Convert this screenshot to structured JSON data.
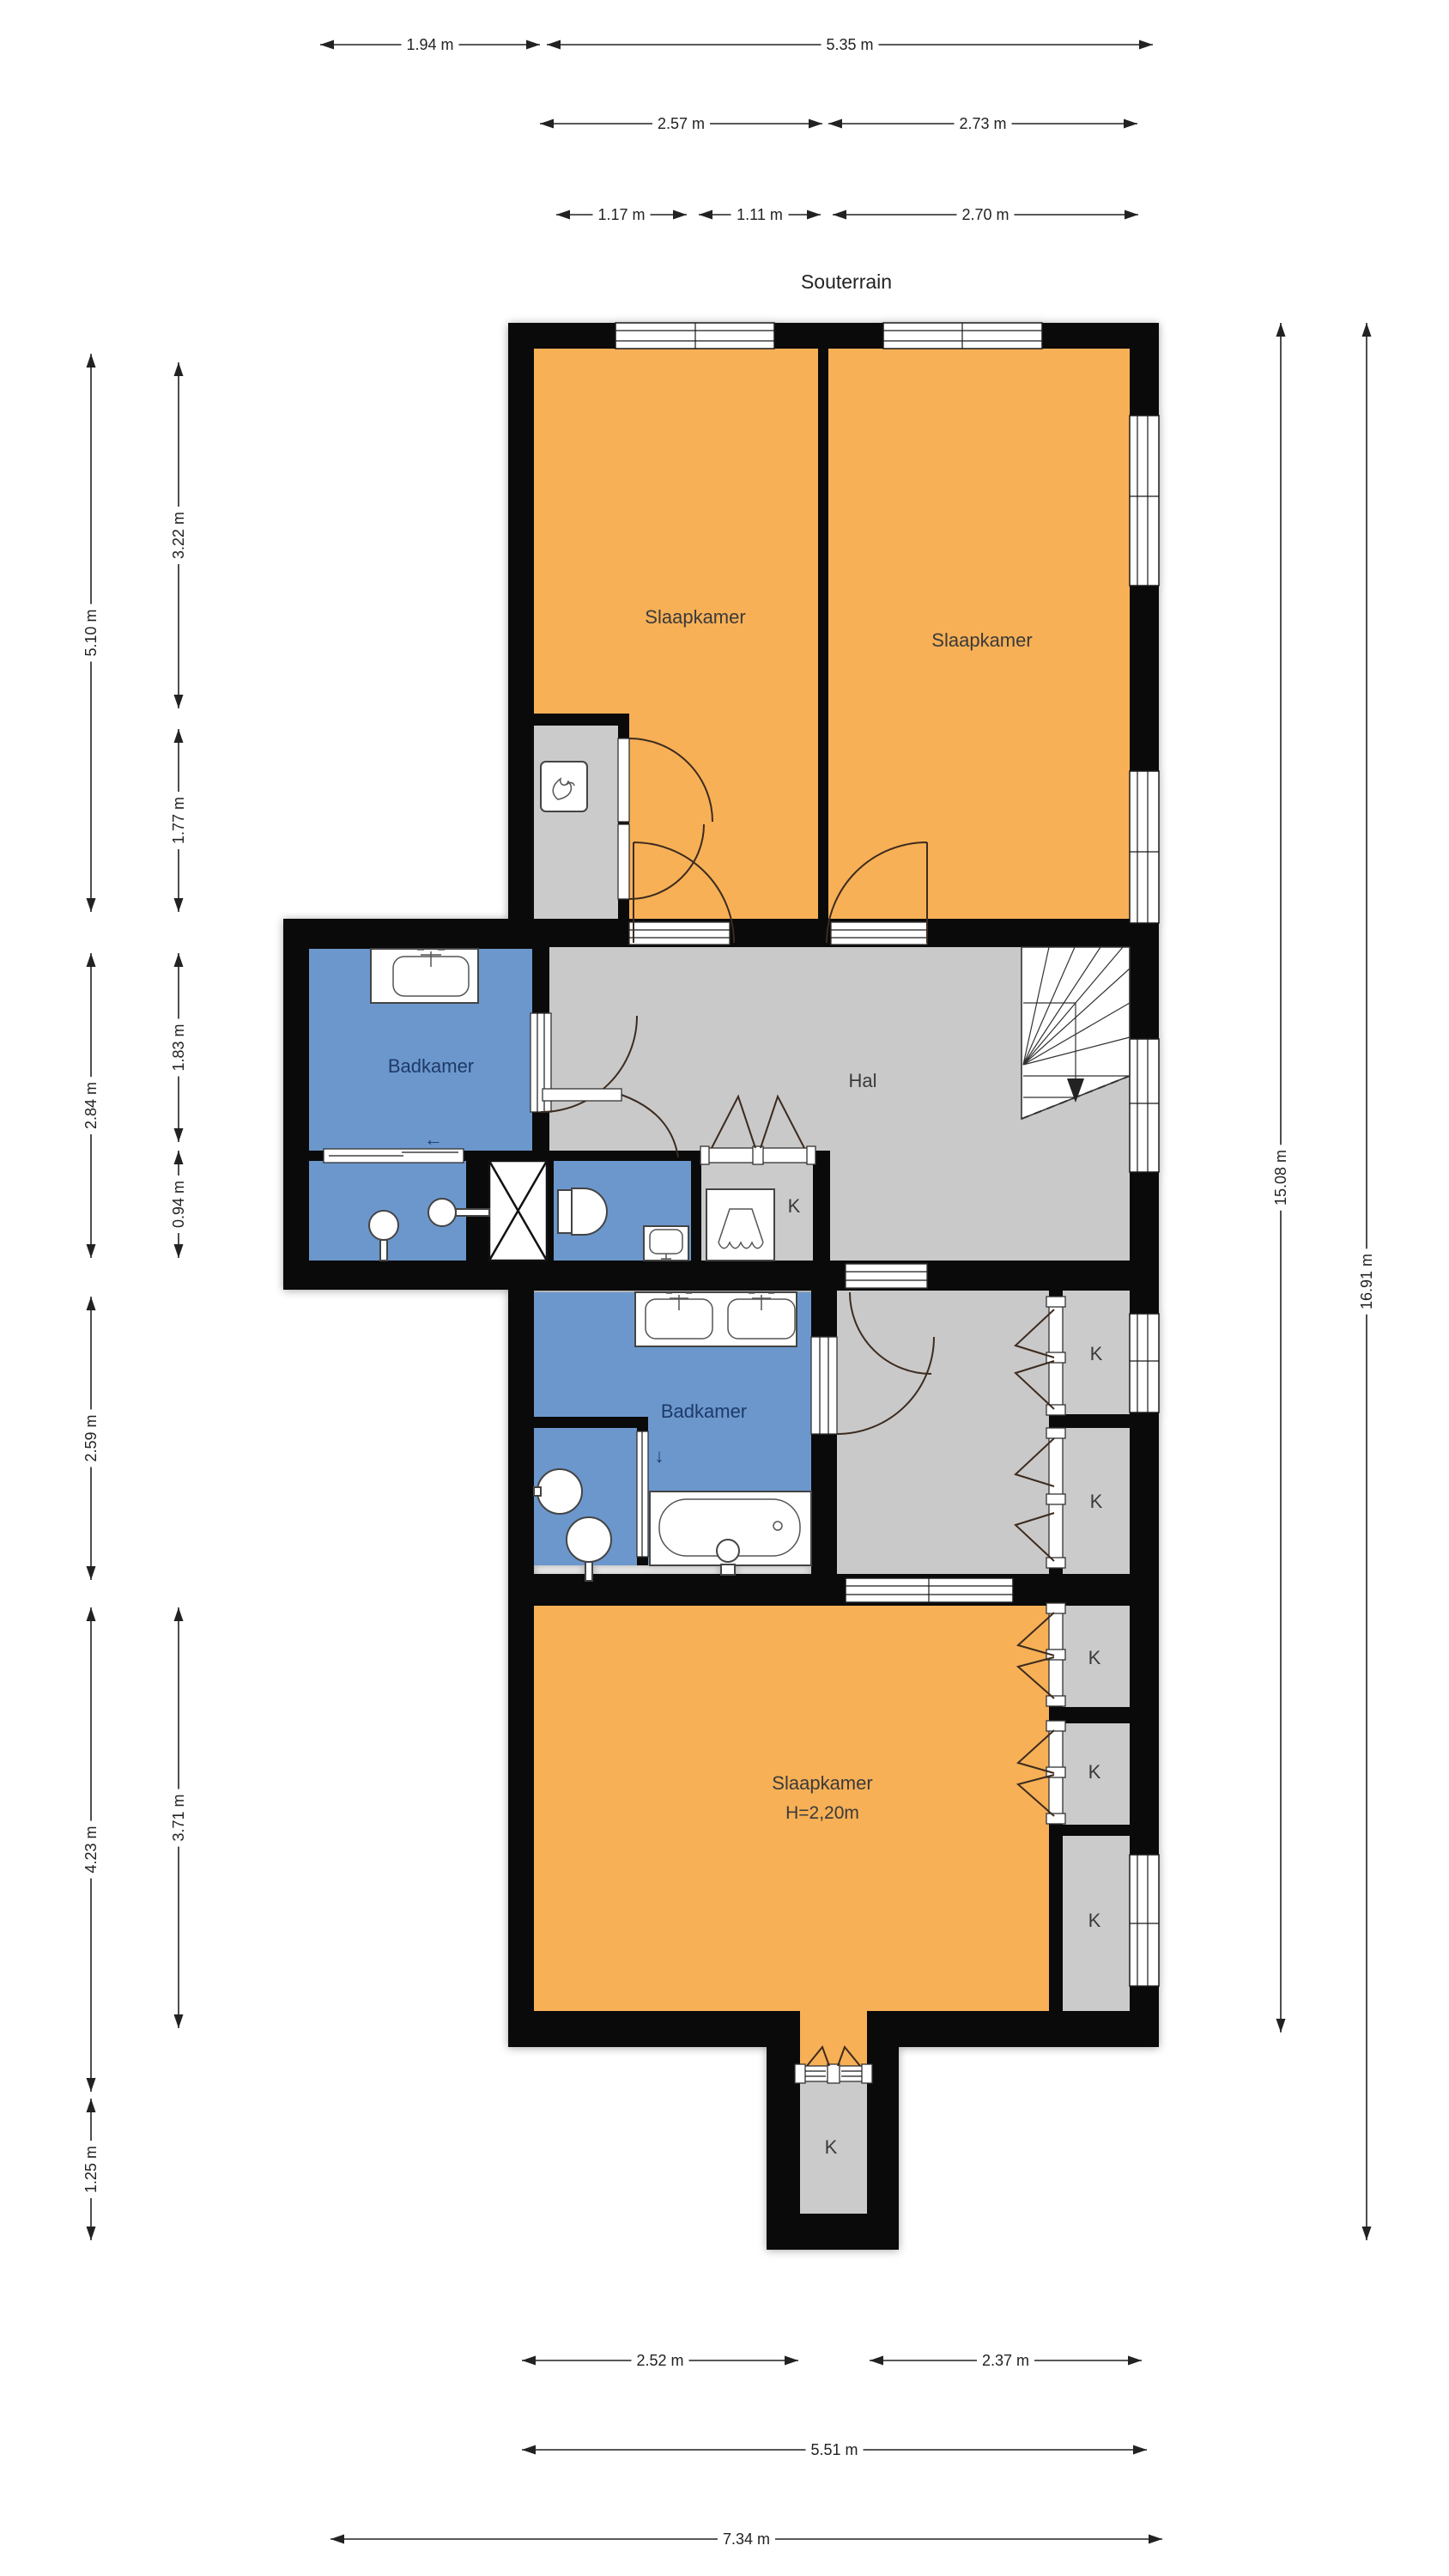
{
  "title": "Souterrain",
  "rooms": {
    "slaapkamer1": {
      "label": "Slaapkamer"
    },
    "slaapkamer2": {
      "label": "Slaapkamer"
    },
    "badkamer1": {
      "label": "Badkamer",
      "exit_arrow": "←"
    },
    "hal": {
      "label": "Hal"
    },
    "badkamer2": {
      "label": "Badkamer",
      "exit_arrow": "↓"
    },
    "slaapkamer3": {
      "label": "Slaapkamer",
      "height_note": "H=2,20m"
    },
    "closet": {
      "label": "K"
    }
  },
  "dimensions": {
    "top_row1": [
      "1.94 m",
      "5.35 m"
    ],
    "top_row2": [
      "2.57 m",
      "2.73 m"
    ],
    "top_row3": [
      "1.17 m",
      "1.11 m",
      "2.70 m"
    ],
    "left_outer": [
      "5.10 m",
      "2.84 m",
      "2.59 m",
      "4.23 m",
      "1.25 m"
    ],
    "left_inner": [
      "3.22 m",
      "1.77 m",
      "1.83 m",
      "0.94 m",
      "3.71 m"
    ],
    "right": [
      "15.08 m",
      "16.91 m"
    ],
    "bottom_row1": [
      "2.52 m",
      "2.37 m"
    ],
    "bottom_row2": [
      "5.51 m"
    ],
    "bottom_row3": [
      "7.34 m"
    ]
  },
  "colors": {
    "bedroom": "#F7B056",
    "bathroom": "#6B97CC",
    "hall": "#C9C9C9",
    "closet": "#CBCBCB",
    "wall": "#0a0a0a",
    "bath_label": "#1E3A68",
    "room_label": "#3A3A3A",
    "dimension": "#222222"
  }
}
